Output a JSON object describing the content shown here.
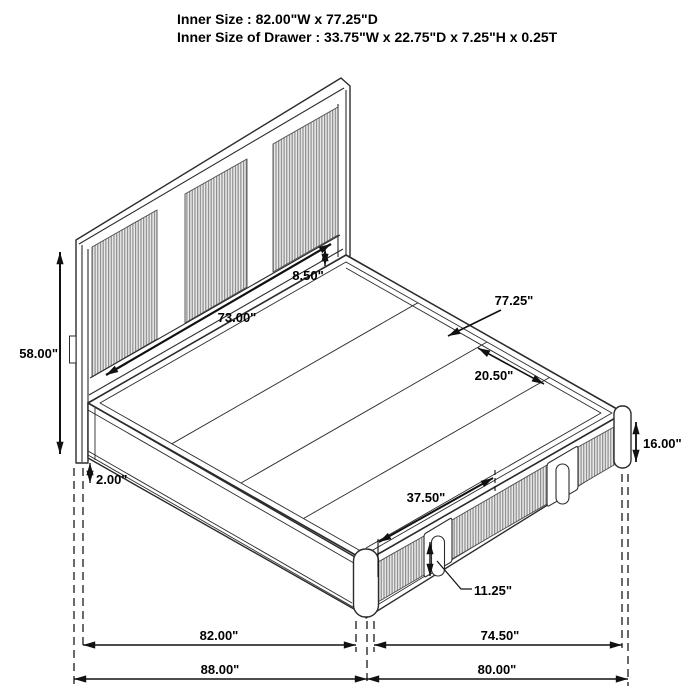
{
  "header": {
    "line1": "Inner Size : 82.00\"W x 77.25\"D",
    "line2": "Inner Size of Drawer : 33.75\"W x 22.75\"D x 7.25\"H x 0.25T"
  },
  "diagram": {
    "subject": "storage-bed-isometric-dimension-drawing",
    "dims": {
      "headboard_height": "58.00\"",
      "leg_clearance": "2.00\"",
      "headboard_inner_width": "73.00\"",
      "panel_to_deck_gap": "8.50\"",
      "platform_depth": "77.25\"",
      "deck_slat_spacing": "20.50\"",
      "footboard_height": "16.00\"",
      "drawer_front_width": "37.50\"",
      "drawer_handle_cutout": "11.25\"",
      "inner_width": "82.00\"",
      "right_inner_span": "74.50\"",
      "overall_width": "88.00\"",
      "overall_depth": "80.00\""
    },
    "colors": {
      "background": "#ffffff",
      "line": "#2b2b2b",
      "rib_dark": "#8a8a8a",
      "rib_light": "#e9e9e9",
      "text": "#000000"
    }
  }
}
